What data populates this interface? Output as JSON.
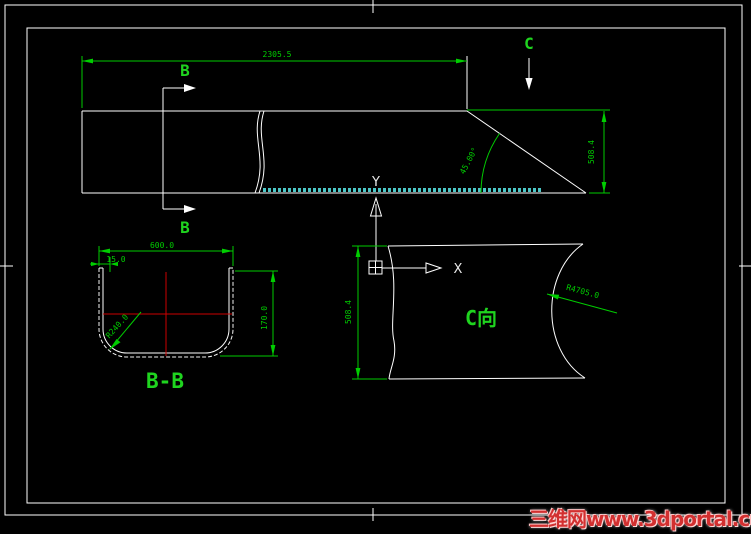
{
  "views": {
    "main": {
      "length_dim": "2305.5",
      "height_dim": "508.4",
      "bevel_angle": "45.00°",
      "section_marker_top": "B",
      "section_marker_bottom": "B",
      "view_marker": "C"
    },
    "ucs": {
      "x_label": "X",
      "y_label": "Y"
    },
    "section_bb": {
      "title": "B-B",
      "width_dim": "600.0",
      "thickness_dim": "15.0",
      "depth_dim": "170.0",
      "corner_radius": "R240.0"
    },
    "view_c": {
      "title": "C向",
      "height_dim": "508.4",
      "arc_radius": "R4705.0"
    }
  },
  "watermark": {
    "text": "三维网www.3dportal.cn"
  },
  "palette": {
    "background": "#000000",
    "object_lines": "#ffffff",
    "dimension_lines": "#00cd00",
    "centerlines": "#cc0000",
    "weld_band": "#4cc8c8",
    "watermark_red": "#d23030"
  }
}
